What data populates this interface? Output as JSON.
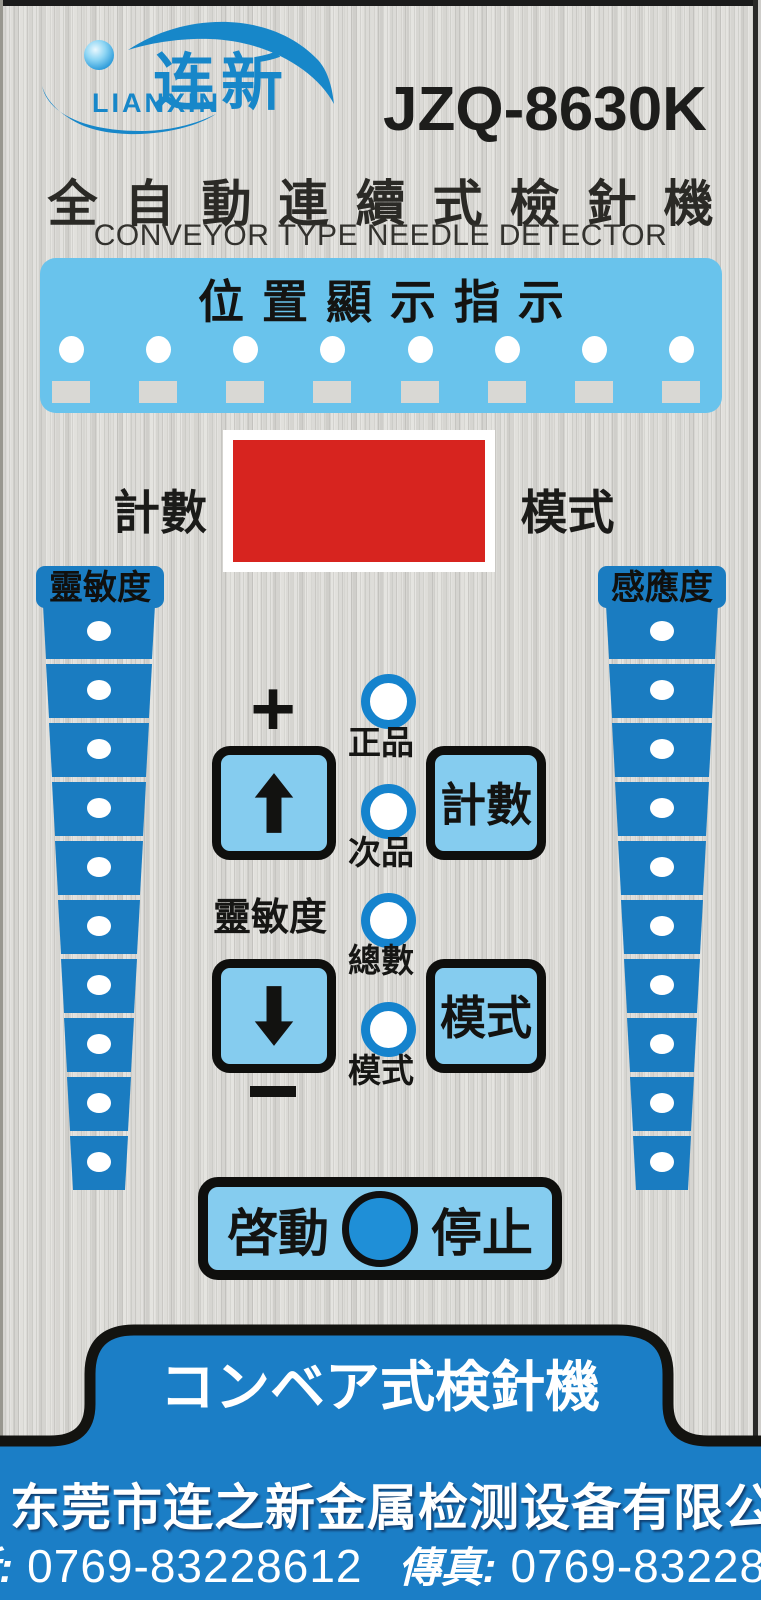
{
  "brand": {
    "logo_cn": "连新",
    "logo_en": "LIANXIN",
    "model": "JZQ-8630K"
  },
  "header": {
    "title_cn": "全自動連續式檢針機",
    "title_en": "CONVEYOR TYPE NEEDLE DETECTOR"
  },
  "position_panel": {
    "title": "位置顯示指示",
    "led_count": 8,
    "indicator_count": 8
  },
  "counter_display": {
    "left_label": "計數",
    "right_label": "模式"
  },
  "sensitivity_columns": {
    "left": {
      "label": "靈敏度",
      "segments": 10
    },
    "right": {
      "label": "感應度",
      "segments": 10
    }
  },
  "controls": {
    "plus": "+",
    "minus": "−",
    "sensitivity_label": "靈敏度",
    "count_button": "計數",
    "mode_button": "模式",
    "leds": [
      {
        "label": "正品"
      },
      {
        "label": "次品"
      },
      {
        "label": "總數"
      },
      {
        "label": "模式"
      }
    ],
    "start_stop": {
      "start": "啓動",
      "stop": "停止"
    }
  },
  "footer": {
    "tab_title": "コンベア式検針機",
    "company": "东莞市连之新金属检测设备有限公司",
    "phone_label": "電話:",
    "phone_number": "0769-83228612",
    "fax_label": "傳真:",
    "fax_number": "0769-83228650"
  },
  "colors": {
    "accent_blue": "#1a7cc1",
    "panel_light_blue": "#69c3ec",
    "button_blue": "#85ccef",
    "display_red": "#d7241f",
    "footer_blue": "#1b7ec6",
    "logo_blue": "#1787c9",
    "led_ring_blue": "#1583cd",
    "start_circle_blue": "#1f8fd7"
  }
}
